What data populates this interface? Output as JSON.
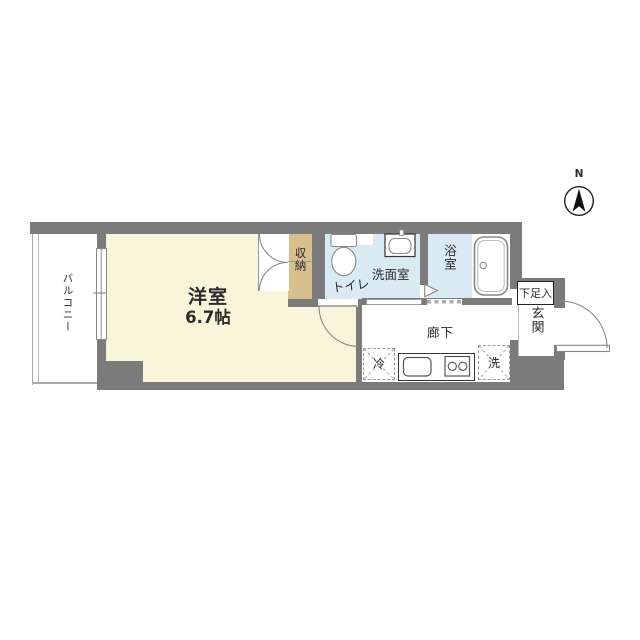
{
  "compass": {
    "north_label": "N"
  },
  "rooms": {
    "balcony": "バルコニー",
    "western_room": "洋室",
    "western_room_size": "6.7帖",
    "closet": "収納",
    "toilet": "トイレ",
    "washroom": "洗面室",
    "bathroom": "浴室",
    "hallway": "廊下",
    "entrance": "玄関",
    "shoe_cabinet": "下足入",
    "refrigerator": "冷",
    "washing_machine": "洗"
  },
  "colors": {
    "wall": "#7b7b7b",
    "western_room_fill": "#f8f5da",
    "closet_fill": "#d8bf8e",
    "wet_area_fill": "#d9eaf2",
    "line": "#888888",
    "text": "#2a2a2a"
  }
}
